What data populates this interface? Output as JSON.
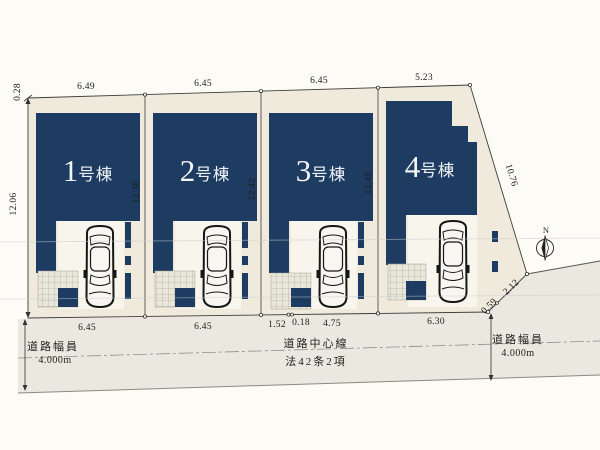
{
  "plan": {
    "colors": {
      "building_navy": "#1e3c61",
      "lot_fill": "#efeadb",
      "road_fill": "#eae8df",
      "line": "#3c3c3c"
    },
    "buildings": [
      {
        "num": "1",
        "suffix": "号棟",
        "label": "1号棟"
      },
      {
        "num": "2",
        "suffix": "号棟",
        "label": "2号棟"
      },
      {
        "num": "3",
        "suffix": "号棟",
        "label": "3号棟"
      },
      {
        "num": "4",
        "suffix": "号棟",
        "label": "4号棟"
      }
    ],
    "dimensions": {
      "top": [
        "6.49",
        "6.45",
        "6.45",
        "5.23"
      ],
      "bottom": [
        "6.45",
        "6.45",
        "1.52",
        "0.18",
        "4.75",
        "6.30"
      ],
      "left_edge_top": "0.28",
      "left_edge": "12.06",
      "between_lots": [
        "12.38",
        "12.42",
        "12.40"
      ],
      "right_slant": "10.76",
      "right_corner_upper": "2.12",
      "right_corner_lower": "0.59"
    },
    "road": {
      "left_width_label": "道路幅員",
      "left_width_value": "4.000m",
      "center_line_label": "道路中心線",
      "center_law_label": "法42条2項",
      "right_width_label": "道路幅員",
      "right_width_value": "4.000m"
    },
    "compass": {
      "label": "N"
    }
  }
}
